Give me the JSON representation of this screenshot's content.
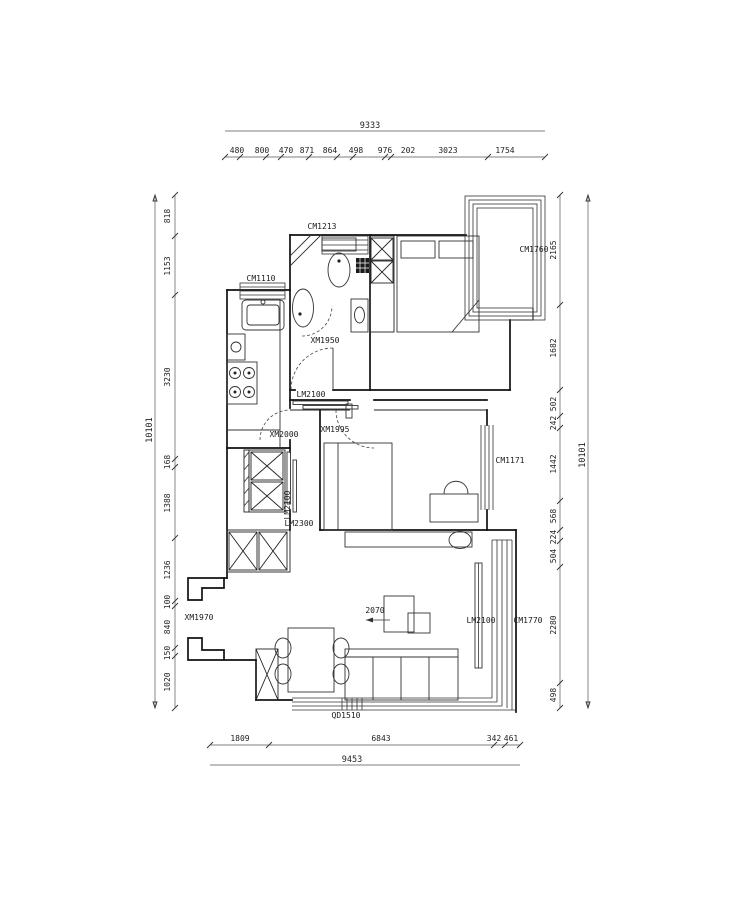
{
  "drawing": {
    "type": "floor-plan",
    "line_color": "#111111",
    "background": "#ffffff"
  },
  "dimensions": {
    "top": {
      "total": "9333",
      "segments": [
        "480",
        "800",
        "470",
        "871",
        "864",
        "498",
        "976",
        "202",
        "3023",
        "1754"
      ]
    },
    "bottom": {
      "total": "9453",
      "segments": [
        "1809",
        "6843",
        "342",
        "461"
      ]
    },
    "left": {
      "total": "10101",
      "segments": [
        "818",
        "1153",
        "3230",
        "168",
        "1388",
        "1236",
        "100",
        "840",
        "150",
        "1020"
      ]
    },
    "right": {
      "total": "10101",
      "segments": [
        "2165",
        "1682",
        "502",
        "242",
        "1442",
        "568",
        "224",
        "504",
        "2280",
        "498"
      ]
    }
  },
  "labels": {
    "window_cm1213": "CM1213",
    "window_cm1110": "CM1110",
    "window_cm1760": "CM1760",
    "door_xm1950": "XM1950",
    "door_lm2100_hall": "LM2100",
    "door_xm2000": "XM2000",
    "door_xm1995": "XM1995",
    "door_lm2100_closet": "LM2100",
    "door_lm2300": "LM2300",
    "window_cm1171": "CM1171",
    "door_xm1970": "XM1970",
    "door_lm2100_balcony": "LM2100",
    "window_cm1770": "CM1770",
    "window_qd1510": "QD1510",
    "sofa_width": "2070"
  }
}
